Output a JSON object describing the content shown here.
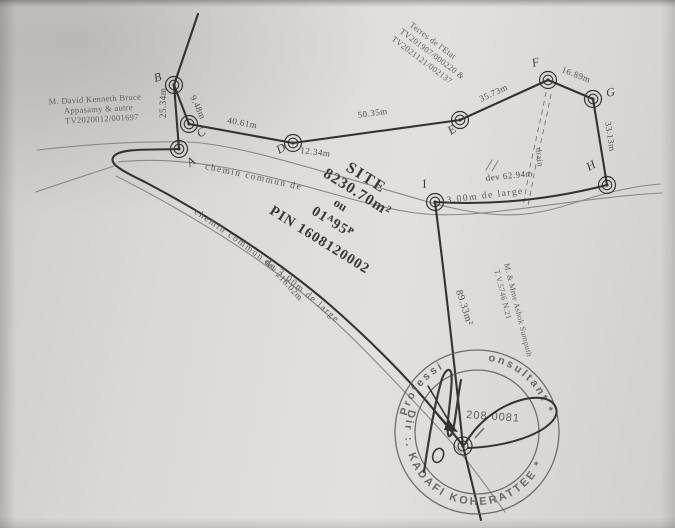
{
  "texts": {
    "owner_left": [
      "M. David  Kenneth  Bruce",
      "Appasamy & autre",
      "TV2020012/001697"
    ],
    "state_land": [
      "Terres de l'Etat",
      "TV201907/000220 &",
      "TV2021121/002137"
    ],
    "site": [
      "SITE",
      "8230.70m²",
      "ou",
      "01ᴬ95ᴾ",
      "PIN 1608120002"
    ],
    "neighbor": [
      "M. & Mme Ashok Sumputh",
      "T.V.5746 N.21"
    ],
    "small_area": "89.33m²",
    "drain": "drain"
  },
  "points": {
    "A": "A",
    "B": "B",
    "C": "C",
    "D": "D",
    "E": "E",
    "F": "F",
    "G": "G",
    "H": "H",
    "I": "I"
  },
  "distances": {
    "ab": "25.34m",
    "bc": "9.48m",
    "cd": "40.61m",
    "d_road": "12.34m",
    "de": "50.35m",
    "ef": "35.73m",
    "fg": "16.89m",
    "gh": "33.13m",
    "ih_dev": "dev   62.94m",
    "road_dev": "dev  216.02m"
  },
  "roads": {
    "upper": "chemin    commun    de",
    "upper2": "3.00m  de  large",
    "lower": "chemin   commun   de   3.00m   de   large"
  },
  "stamp": {
    "ring_bottom": "Dir :.  KADAFI KOHERATTEE *",
    "ring_top_left": "Professi",
    "ring_top_right": "onsultant *",
    "number": "208 0081"
  },
  "colors": {
    "ink": "#35332f",
    "paper": "#dcdad5",
    "stamp": "#5e5b55"
  }
}
